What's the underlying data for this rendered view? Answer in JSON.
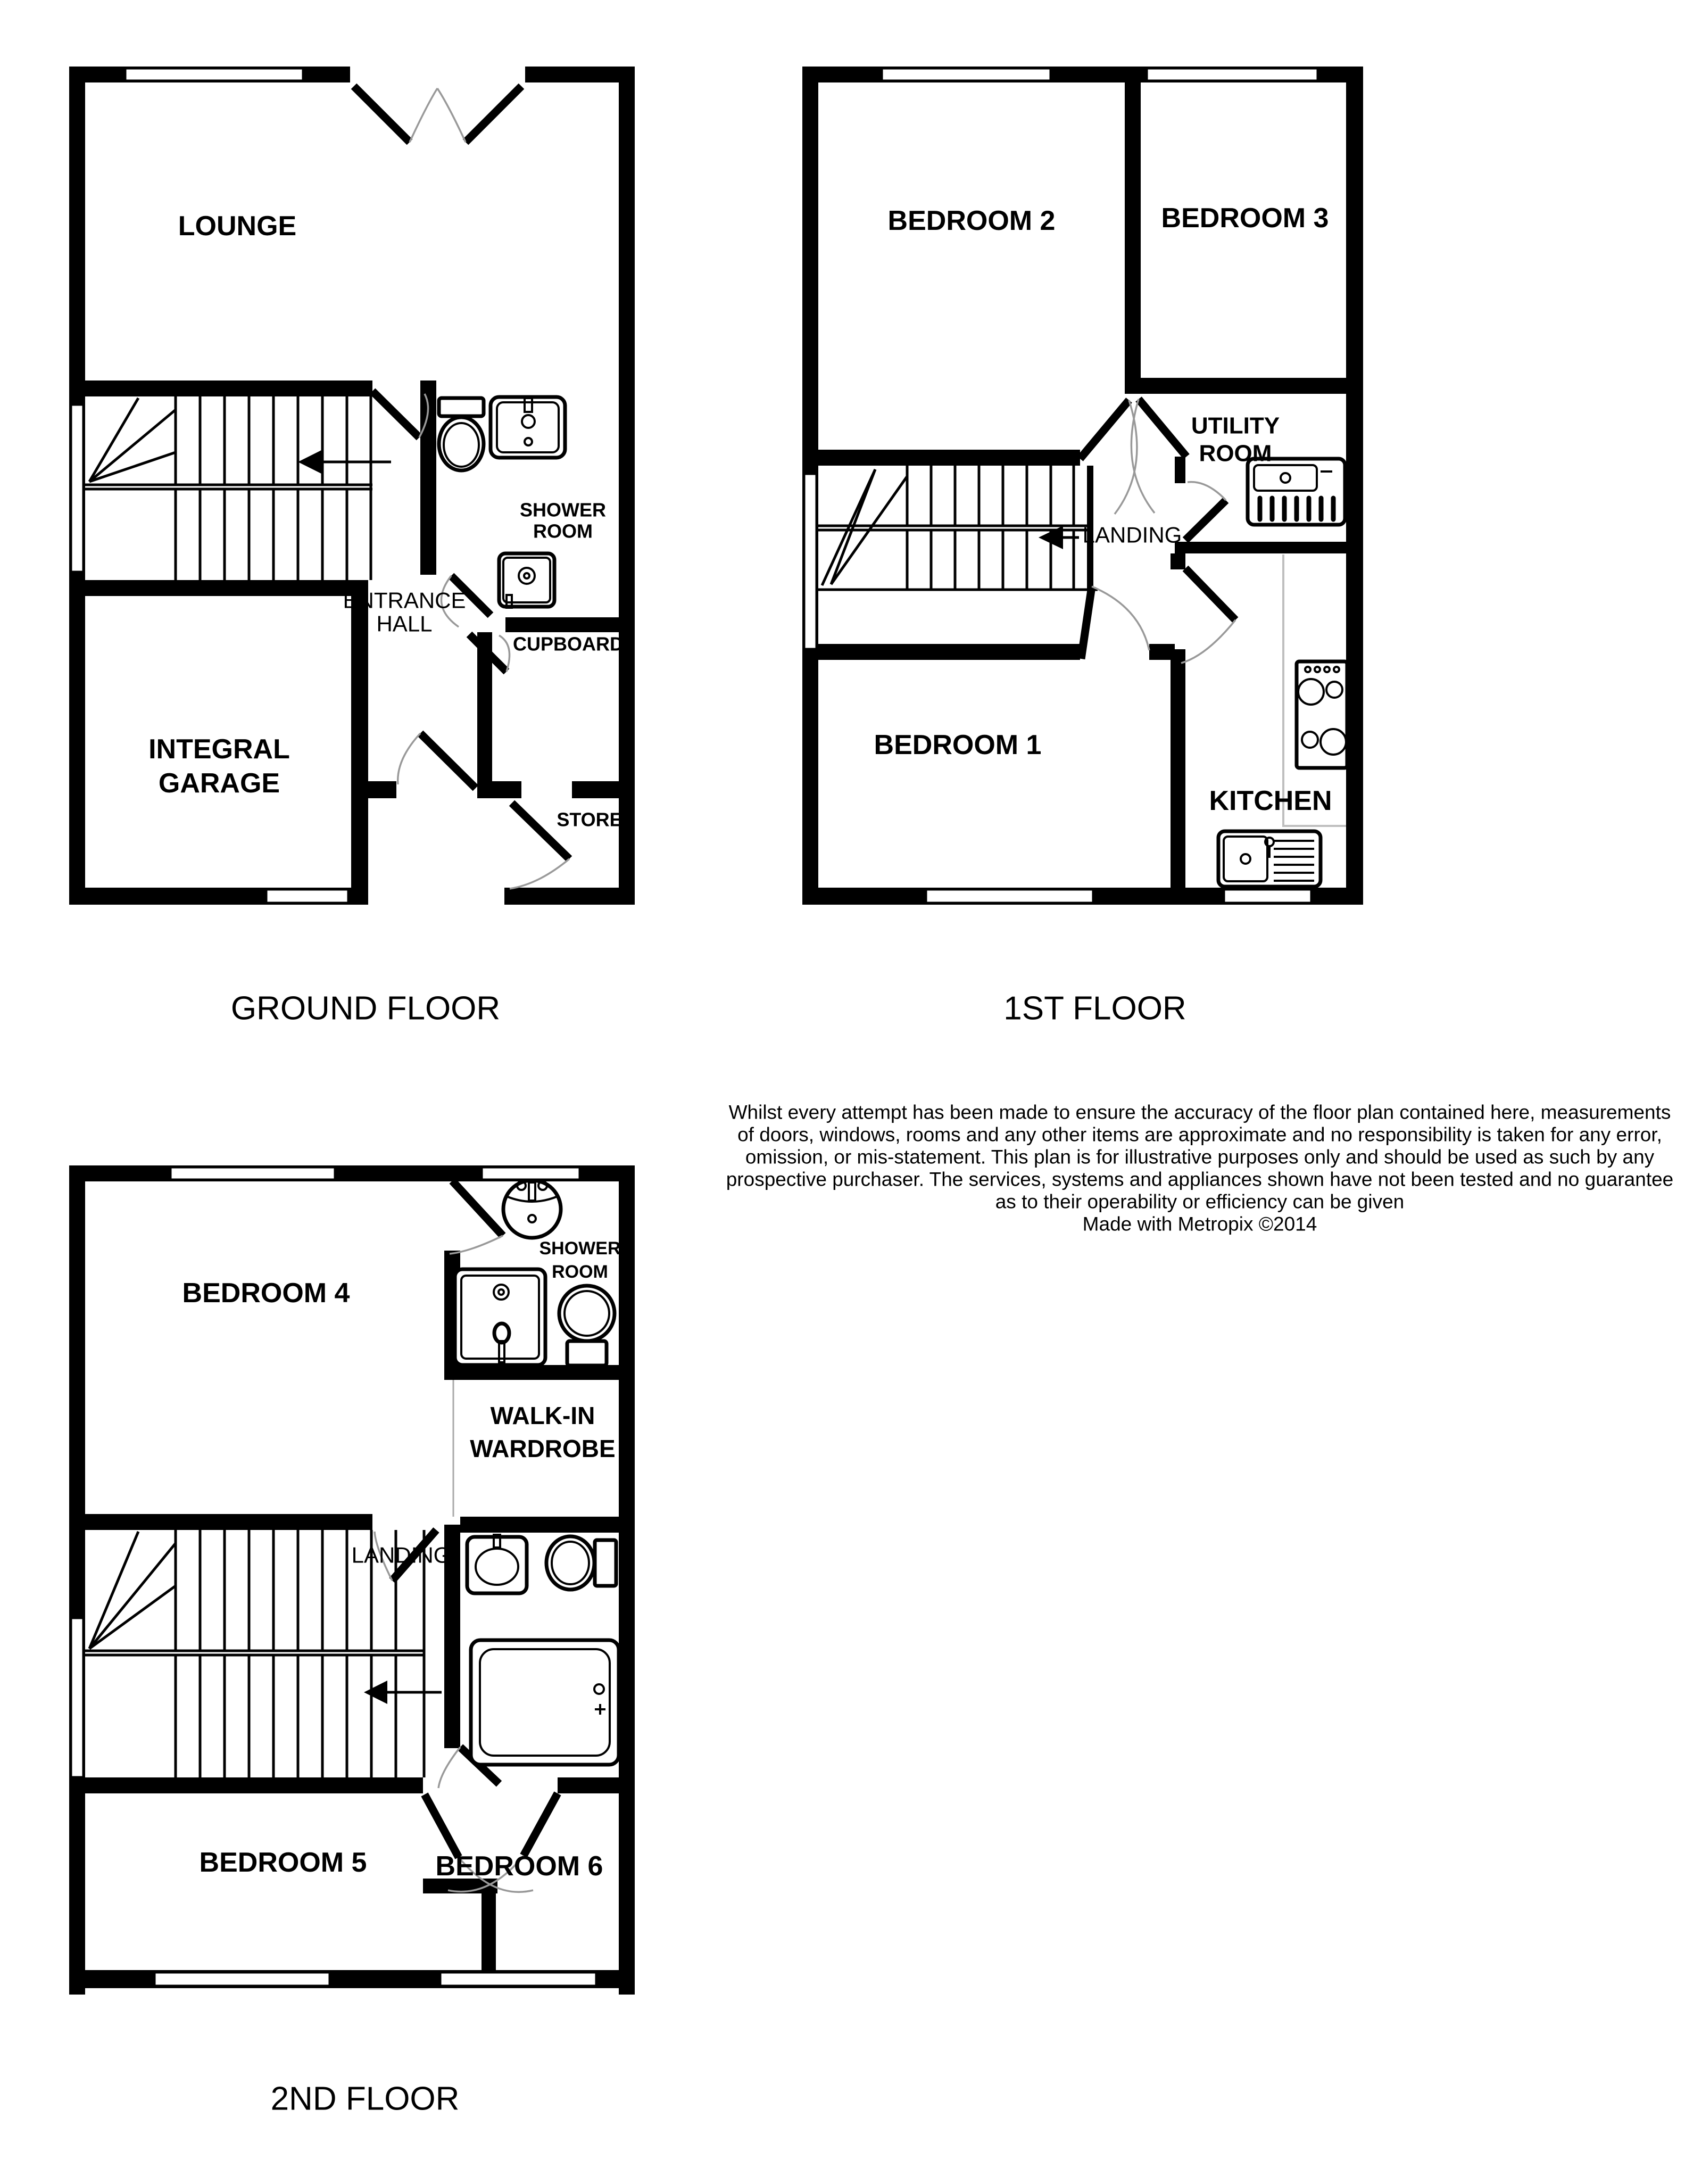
{
  "page": {
    "background_color": "#ffffff",
    "wall_color": "#000000",
    "door_arc_color": "#999999",
    "counter_line_color": "#bfbfbf",
    "made_with": "Made with Metropix ©2014"
  },
  "floors": {
    "ground": {
      "caption": "GROUND FLOOR",
      "rooms": {
        "lounge": {
          "label": "LOUNGE"
        },
        "entrance_hall": {
          "line1": "ENTRANCE",
          "line2": "HALL"
        },
        "shower_room": {
          "line1": "SHOWER",
          "line2": "ROOM"
        },
        "cupboard": {
          "label": "CUPBOARD"
        },
        "store": {
          "label": "STORE"
        },
        "integral_garage": {
          "line1": "INTEGRAL",
          "line2": "GARAGE"
        }
      },
      "fixture_icons": [
        "toilet-icon",
        "sink-icon",
        "shower-tray-icon",
        "stairs-up-arrow-icon"
      ]
    },
    "first": {
      "caption": "1ST FLOOR",
      "rooms": {
        "bedroom2": {
          "label": "BEDROOM 2"
        },
        "bedroom3": {
          "label": "BEDROOM 3"
        },
        "utility_room": {
          "line1": "UTILITY",
          "line2": "ROOM"
        },
        "landing": {
          "label": "LANDING"
        },
        "bedroom1": {
          "label": "BEDROOM 1"
        },
        "kitchen": {
          "label": "KITCHEN"
        }
      },
      "fixture_icons": [
        "utility-sink-icon",
        "hob-icon",
        "kitchen-sink-icon",
        "stairs-up-arrow-icon"
      ]
    },
    "second": {
      "caption": "2ND FLOOR",
      "rooms": {
        "bedroom4": {
          "label": "BEDROOM 4"
        },
        "shower_room": {
          "line1": "SHOWER",
          "line2": "ROOM"
        },
        "walk_in_wardrobe": {
          "line1": "WALK-IN",
          "line2": "WARDROBE"
        },
        "landing": {
          "label": "LANDING"
        },
        "bedroom5": {
          "label": "BEDROOM 5"
        },
        "bedroom6": {
          "label": "BEDROOM 6"
        }
      },
      "fixture_icons": [
        "basin-icon",
        "shower-tray-icon",
        "toilet-icon",
        "bath-icon",
        "stairs-up-arrow-icon"
      ]
    }
  },
  "disclaimer": {
    "lines": [
      "Whilst every attempt has been made to ensure the accuracy of the floor plan contained here, measurements",
      "of doors, windows, rooms and any other items are approximate and no responsibility is taken for any error,",
      "omission, or mis-statement. This plan is for illustrative purposes only and should be used as such by any",
      "prospective purchaser. The services, systems and appliances shown have not been tested and no guarantee",
      "as to their operability or efficiency can be given",
      "Made with Metropix ©2014"
    ]
  }
}
